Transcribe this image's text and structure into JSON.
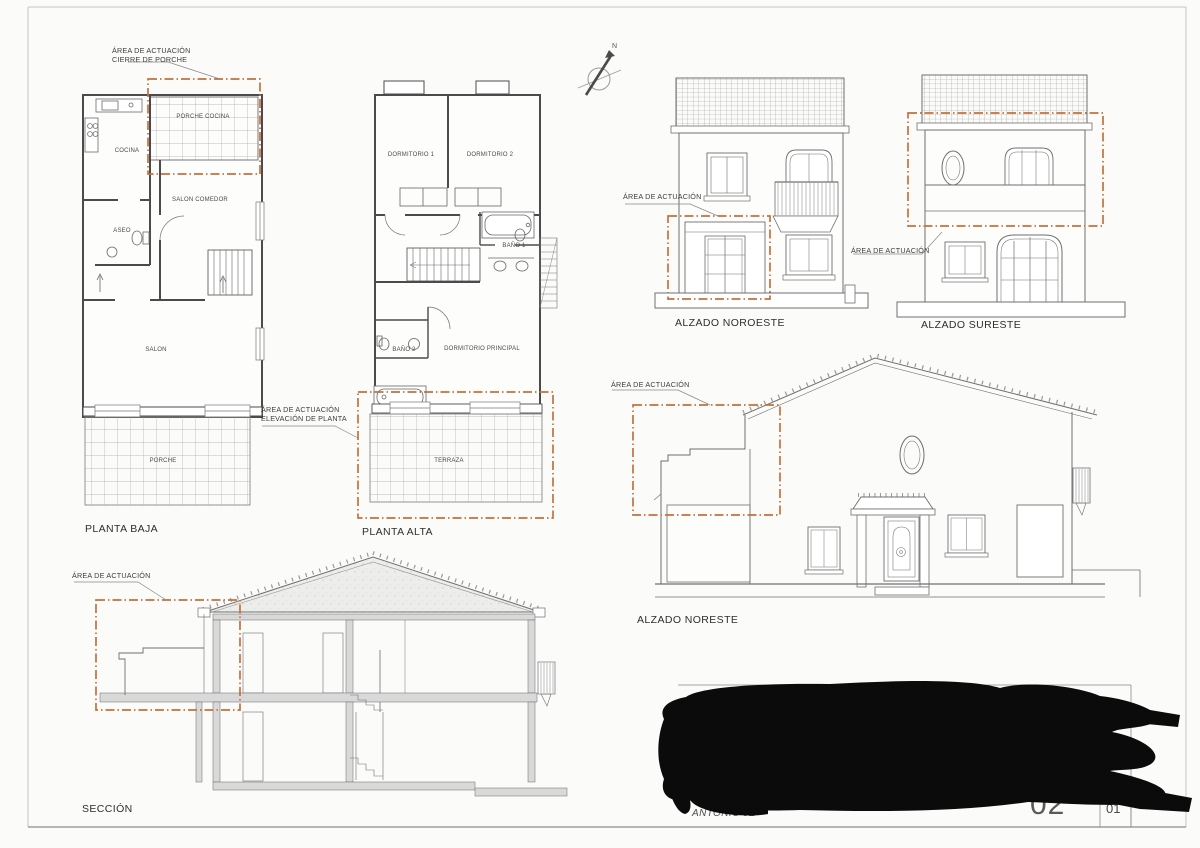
{
  "colors": {
    "highlight": "#c4713e",
    "line": "#4b4b4b",
    "poche": "#d9d9d9"
  },
  "north": {
    "label": "N"
  },
  "annotations": {
    "cierre_porche": {
      "line1": "ÁREA DE ACTUACIÓN",
      "line2": "CIERRE DE PORCHE"
    },
    "elevacion_planta": {
      "line1": "ÁREA DE ACTUACIÓN",
      "line2": "ELEVACIÓN DE PLANTA"
    },
    "noroeste": {
      "line1": "ÁREA DE ACTUACIÓN"
    },
    "sureste": {
      "line1": "ÁREA DE ACTUACIÓN"
    },
    "noreste": {
      "line1": "ÁREA DE ACTUACIÓN"
    },
    "seccion": {
      "line1": "ÁREA DE ACTUACIÓN"
    }
  },
  "planta_baja": {
    "title": "PLANTA BAJA",
    "rooms": {
      "cocina": "COCINA",
      "porche_cocina": "PORCHE COCINA",
      "salon_comedor": "SALON COMEDOR",
      "aseo": "ASEO",
      "salon": "SALON",
      "porche": "PORCHE"
    }
  },
  "planta_alta": {
    "title": "PLANTA ALTA",
    "rooms": {
      "dormitorio_1": "DORMITORIO 1",
      "dormitorio_2": "DORMITORIO 2",
      "bano_1": "BAÑO 1",
      "bano_2": "BAÑO 2",
      "dormitorio_principal": "DORMITORIO PRINCIPAL",
      "terraza": "TERRAZA"
    }
  },
  "elevations": {
    "noroeste": "ALZADO NOROESTE",
    "sureste": "ALZADO SURESTE",
    "noreste": "ALZADO NORESTE",
    "seccion": "SECCIÓN"
  },
  "title_block": {
    "author": "ANTONIO JE",
    "sheet_large": "02",
    "sheet_small": "01"
  }
}
